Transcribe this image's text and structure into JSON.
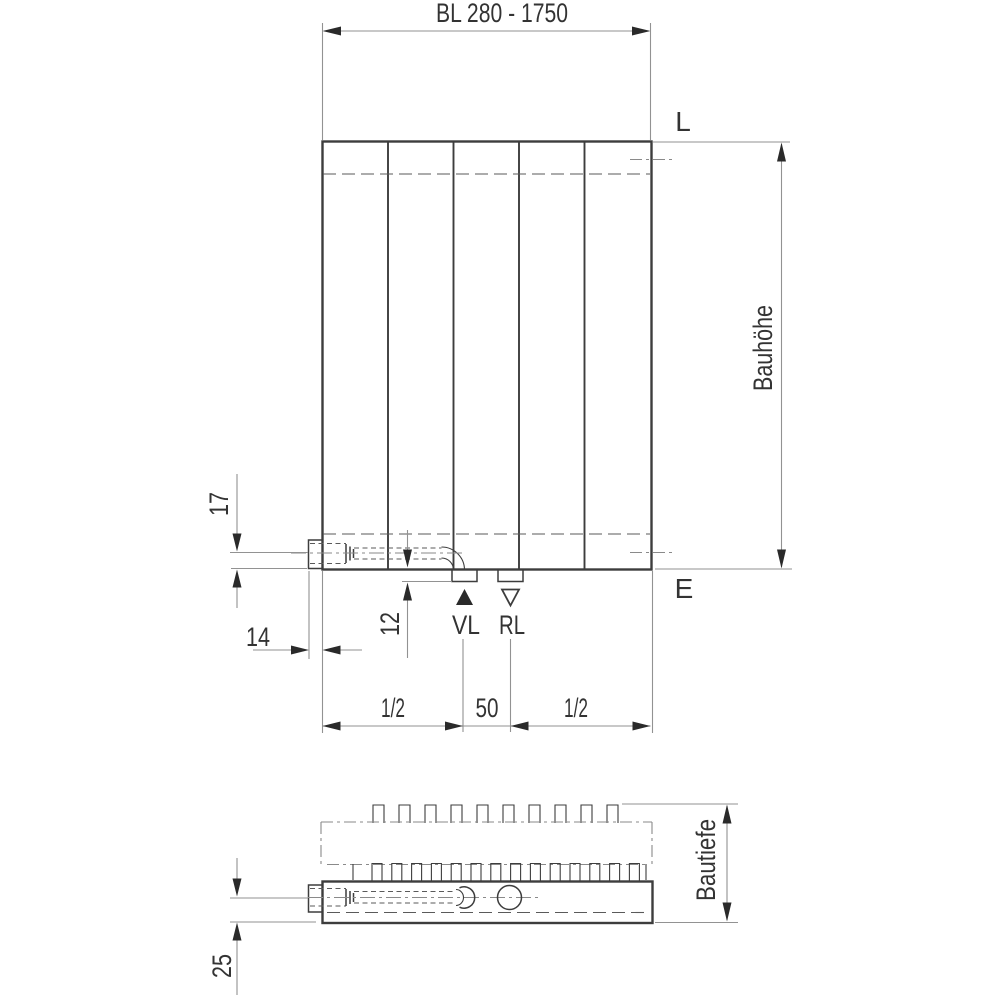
{
  "front_view": {
    "width_dimension_label": "BL 280 - 1750",
    "height_dimension_label": "Bauhöhe",
    "vent_side_label": "L",
    "drain_side_label": "E",
    "flow_label": "VL",
    "return_label": "RL",
    "pipe_center_offset": "17",
    "block_protrusion": "14",
    "nozzle_protrusion": "12",
    "connection_spacing": "50",
    "left_span": "1/2",
    "right_span": "1/2"
  },
  "plan_view": {
    "depth_dimension_label": "Bautiefe",
    "pipe_center_offset": "25"
  },
  "colors": {
    "background": "#ffffff",
    "outline": "#3d3d3d",
    "thin_line": "#929292",
    "hidden_line": "#5a5a5a",
    "centerline": "#8a8a8a",
    "arrow": "#2a2a2a",
    "text": "#333333"
  }
}
